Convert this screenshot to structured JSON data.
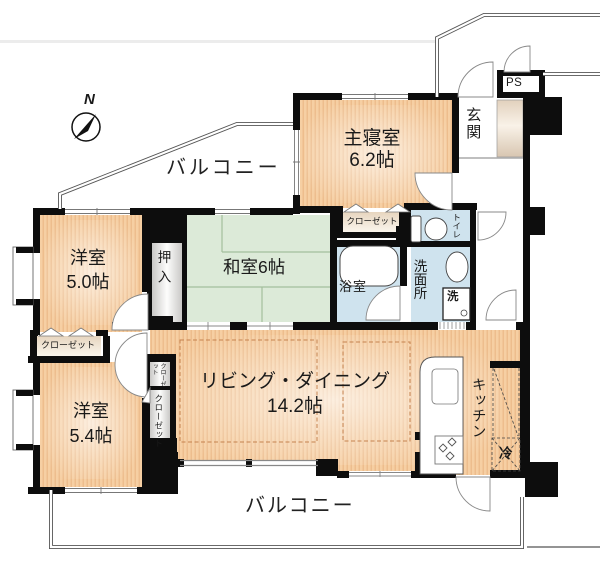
{
  "plan": {
    "compass_label": "N",
    "balcony_top": "バルコニー",
    "balcony_bottom": "バルコニー",
    "rooms": {
      "master_bedroom": {
        "name": "主寝室",
        "size": "6.2帖"
      },
      "entrance": {
        "name": "玄関"
      },
      "pipe_space": {
        "name": "PS"
      },
      "master_closet": {
        "name": "クローゼット"
      },
      "toilet": {
        "name": "トイレ"
      },
      "bathroom": {
        "name": "浴室"
      },
      "washroom": {
        "name": "洗面所"
      },
      "washer": {
        "name": "洗"
      },
      "japanese_room": {
        "name": "和室6帖"
      },
      "oshiire": {
        "name": "押入"
      },
      "western_room_50": {
        "name": "洋室",
        "size": "5.0帖"
      },
      "western_room_50_closet": {
        "name": "クローゼット"
      },
      "western_room_54": {
        "name": "洋室",
        "size": "5.4帖"
      },
      "hall_closet_small": {
        "name": "クローゼット"
      },
      "hall_closet_tall": {
        "name": "クローゼット"
      },
      "living_dining": {
        "name": "リビング・ダイニング",
        "size": "14.2帖"
      },
      "kitchen": {
        "name": "キッチン"
      },
      "refrigerator": {
        "name": "冷"
      }
    },
    "colors": {
      "wall": "#0d0d0d",
      "western_room_fill": "#f6cfa3",
      "tatami_fill": "#dcead8",
      "wet_area_fill": "#cfe3ee",
      "closet_fill": "#ead9c5",
      "storage_fill": "#d7d6d4",
      "dashed_accent": "#c5824e"
    }
  }
}
